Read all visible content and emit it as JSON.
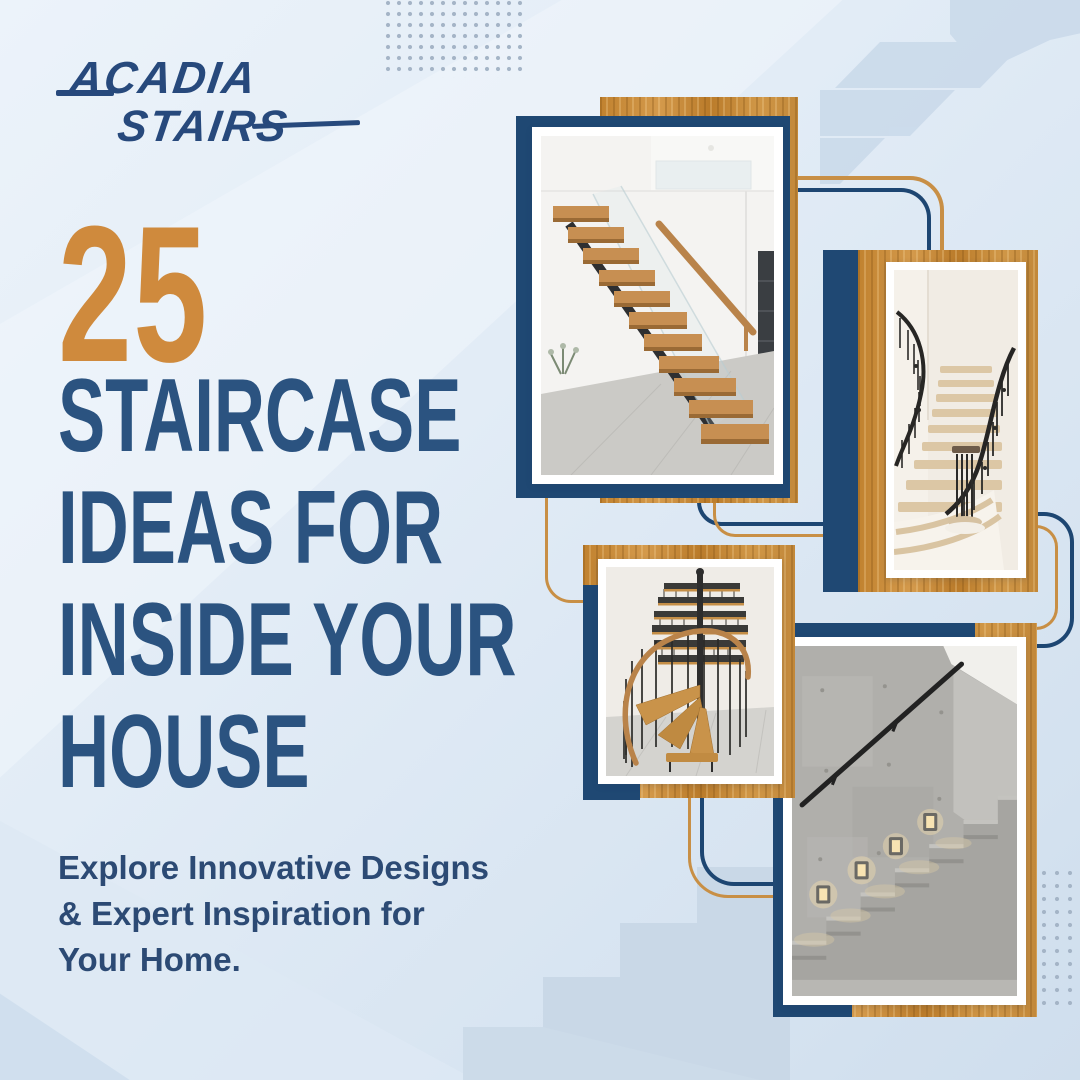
{
  "brand": {
    "line1": "ACADIA",
    "line2": "STAIRS"
  },
  "headline": {
    "number": "25",
    "lines": [
      "STAIRCASE",
      "IDEAS FOR",
      "INSIDE YOUR",
      "HOUSE"
    ]
  },
  "subtitle": {
    "lines": [
      "Explore Innovative Designs",
      "& Expert Inspiration for",
      "Your Home."
    ]
  },
  "photos": [
    {
      "name": "floating-wood-staircase"
    },
    {
      "name": "curved-wrought-iron-staircase"
    },
    {
      "name": "spiral-staircase"
    },
    {
      "name": "concrete-staircase-with-step-lights"
    }
  ],
  "colors": {
    "navy": "#1f4873",
    "headline_blue": "#2b5380",
    "orange": "#cf8a3d",
    "wood": "#c68c3e",
    "background": "#dfeaf5",
    "step_silhouette": "#ccdbe9"
  }
}
